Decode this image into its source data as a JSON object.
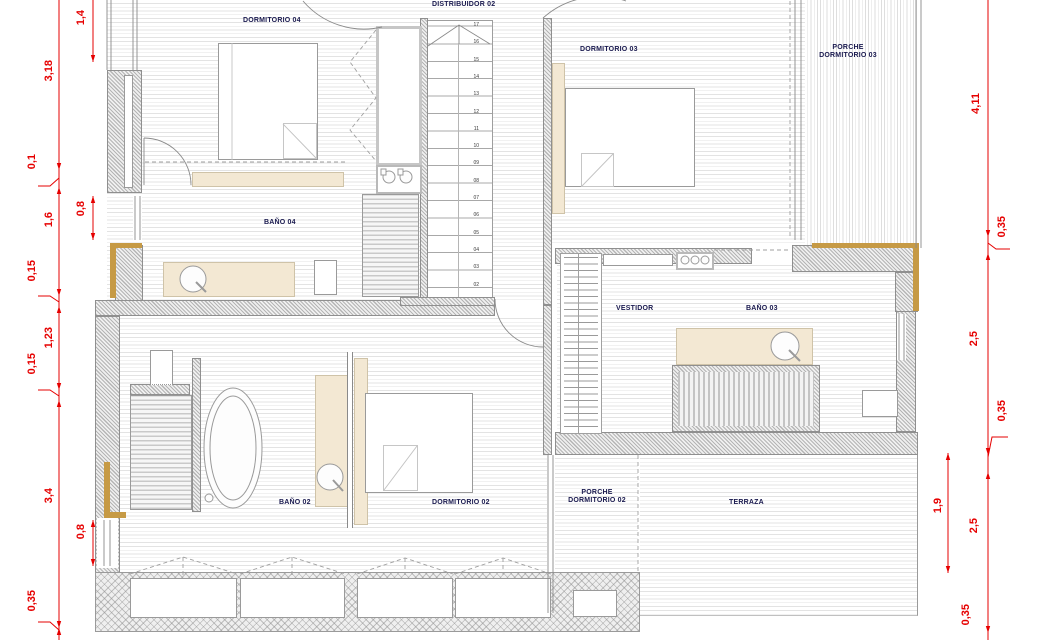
{
  "plan": {
    "rooms": {
      "dormitorio04": "DORMITORIO 04",
      "distribuidor02": "DISTRIBUIDOR 02",
      "dormitorio03": "DORMITORIO 03",
      "porche03_line1": "PORCHE",
      "porche03_line2": "DORMITORIO 03",
      "bano04": "BAÑO 04",
      "vestidor": "VESTIDOR",
      "bano03": "BAÑO 03",
      "bano02": "BAÑO 02",
      "dormitorio02": "DORMITORIO 02",
      "porche02_line1": "PORCHE",
      "porche02_line2": "DORMITORIO 02",
      "terraza": "TERRAZA"
    },
    "dimensions": {
      "left": [
        "1,4",
        "3,18",
        "0,1",
        "0,8",
        "1,6",
        "0,15",
        "1,23",
        "0,15",
        "3,4",
        "0,8",
        "0,35"
      ],
      "right": [
        "4,11",
        "0,35",
        "2,5",
        "0,35",
        "1,9",
        "2,5",
        "0,35"
      ]
    },
    "stairs": {
      "steps": [
        "17",
        "16",
        "15",
        "14",
        "13",
        "12",
        "11",
        "10",
        "09",
        "08",
        "07",
        "06",
        "05",
        "04",
        "03",
        "02"
      ]
    },
    "colors": {
      "dimension_red": "#e60000",
      "label_ink": "#1a1a4f",
      "furniture_beige": "#f3e8d3",
      "trim_tan": "#c69a45"
    }
  }
}
